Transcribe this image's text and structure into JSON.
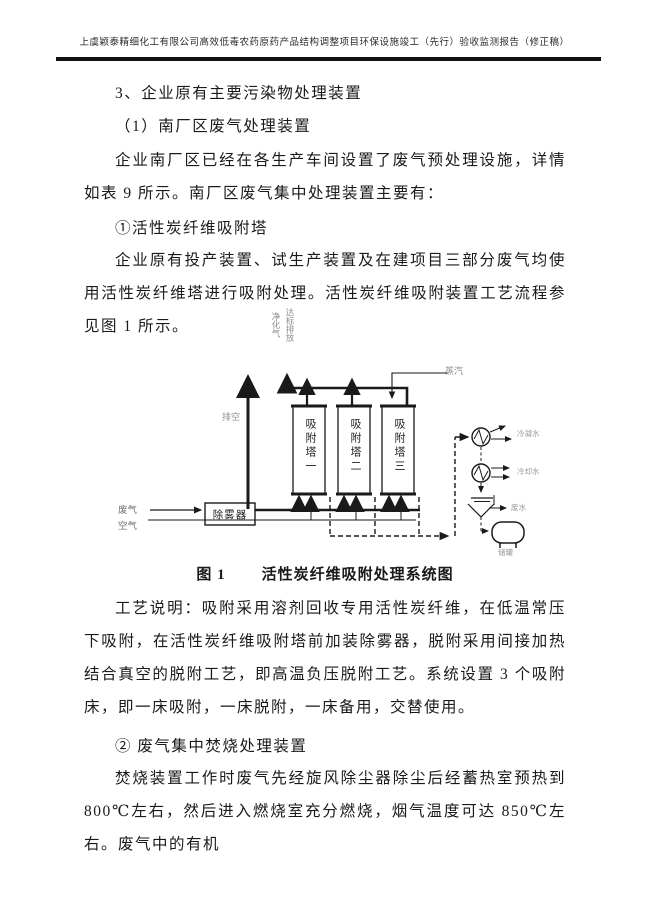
{
  "header": {
    "title": "上虞颖泰精细化工有限公司高效低毒农药原药产品结构调整项目环保设施竣工（先行）验收监测报告（修正稿）"
  },
  "body": {
    "p1": "3、企业原有主要污染物处理装置",
    "p2": "（1）南厂区废气处理装置",
    "p3": "企业南厂区已经在各生产车间设置了废气预处理设施，详情如表 9 所示。南厂区废气集中处理装置主要有：",
    "p4": "①活性炭纤维吸附塔",
    "p5": "企业原有投产装置、试生产装置及在建项目三部分废气均使用活性炭纤维塔进行吸附处理。活性炭纤维吸附装置工艺流程参见图 1 所示。",
    "p6": "工艺说明：吸附采用溶剂回收专用活性炭纤维，在低温常压下吸附，在活性炭纤维吸附塔前加装除雾器，脱附采用间接加热结合真空的脱附工艺，即高温负压脱附工艺。系统设置 3 个吸附床，即一床吸附，一床脱附，一床备用，交替使用。",
    "p7": "② 废气集中焚烧处理装置",
    "p8": "焚烧装置工作时废气先经旋风除尘器除尘后经蓄热室预热到 800℃左右，然后进入燃烧室充分燃烧，烟气温度可达 850℃左右。废气中的有机"
  },
  "caption": {
    "label": "图 1",
    "title": "活性炭纤维吸附处理系统图"
  },
  "diagram": {
    "stack_note_col1": "净化气",
    "stack_note_col2": "达标排放",
    "vent_label": "排空",
    "steam_label": "蒸汽",
    "waste_gas_label": "废气",
    "air_label": "空气",
    "demister_label": "除雾器",
    "tower1_label": "吸附塔一",
    "tower2_label": "吸附塔二",
    "tower3_label": "吸附塔三",
    "condenser_out_label": "冷凝水",
    "cooler_out_label": "冷却水",
    "wastewater_label": "废水",
    "tank_label": "储罐"
  },
  "colors": {
    "ink": "#1a1a1a",
    "faint_label": "#8f8f8f"
  }
}
